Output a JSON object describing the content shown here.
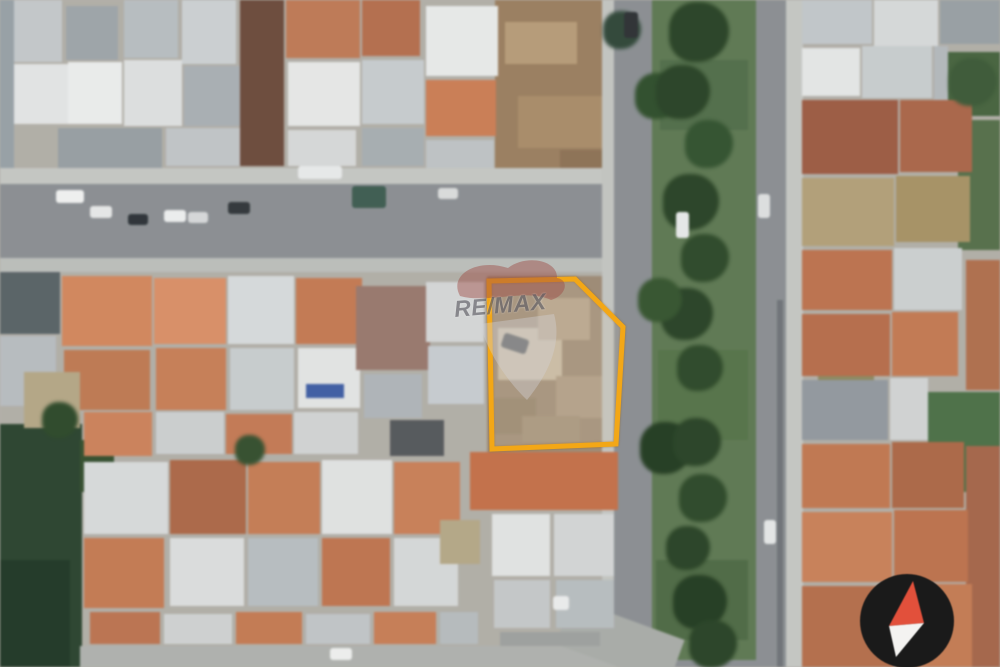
{
  "meta": {
    "width": 1000,
    "height": 667
  },
  "watermark": {
    "brand": "RE/MAX",
    "text_color": "#5f5e66",
    "text_opacity": 0.65,
    "balloon_top_color": "#9e4a42",
    "balloon_body_color": "#d3d2d6"
  },
  "overlay": {
    "label": "highlighted-lot-boundary",
    "stroke": "#F3A716",
    "stroke_width": 5,
    "fill": "rgba(255,255,255,0.12)",
    "points": [
      [
        489,
        281
      ],
      [
        575,
        279
      ],
      [
        623,
        327
      ],
      [
        616,
        444
      ],
      [
        492,
        449
      ]
    ]
  },
  "compass": {
    "left": 850,
    "top": 564,
    "size": 114,
    "bg": "#1a1a1a",
    "north_color": "#e2503b",
    "south_color": "#f4f3f1",
    "circle": {
      "cx": 57,
      "cy": 57,
      "r": 47
    },
    "north_points": "63,17 74,59 39,62",
    "south_points": "74,59 46,93 39,62"
  },
  "scene": {
    "base": "#b3b0a8",
    "rects": [
      [
        0,
        0,
        14,
        170,
        "#98a2a8"
      ],
      [
        495,
        0,
        122,
        183,
        "#9d8060"
      ],
      [
        505,
        22,
        72,
        42,
        "#b99d78"
      ],
      [
        518,
        96,
        84,
        52,
        "#ab8d69"
      ],
      [
        560,
        150,
        56,
        32,
        "#8f7355"
      ],
      [
        487,
        276,
        136,
        176,
        "#a08c76"
      ],
      [
        498,
        328,
        64,
        52,
        "#cabca4"
      ],
      [
        538,
        298,
        52,
        42,
        "#b7a48b"
      ],
      [
        556,
        376,
        48,
        42,
        "#af9c84"
      ],
      [
        494,
        398,
        42,
        36,
        "#97856c"
      ],
      [
        522,
        416,
        58,
        26,
        "#a5927a"
      ],
      [
        0,
        424,
        82,
        243,
        "#2c4630"
      ],
      [
        0,
        560,
        70,
        107,
        "#223a28"
      ],
      [
        80,
        440,
        34,
        52,
        "#35512f"
      ],
      [
        946,
        52,
        54,
        64,
        "#47663f"
      ],
      [
        958,
        120,
        42,
        130,
        "#56714a"
      ],
      [
        928,
        392,
        72,
        100,
        "#4c7247"
      ],
      [
        818,
        336,
        56,
        44,
        "#8f8a60"
      ],
      [
        0,
        168,
        640,
        16,
        "#c6c8c4"
      ],
      [
        0,
        184,
        640,
        74,
        "#8c9094"
      ],
      [
        0,
        258,
        640,
        14,
        "#bdc0bc"
      ],
      [
        602,
        0,
        14,
        667,
        "#c4c6c2"
      ],
      [
        614,
        0,
        176,
        667,
        "#8c9094"
      ],
      [
        652,
        0,
        104,
        660,
        "#5e7a52"
      ],
      [
        660,
        60,
        88,
        70,
        "#52704a"
      ],
      [
        658,
        350,
        90,
        90,
        "#567549"
      ],
      [
        656,
        560,
        92,
        80,
        "#4f6c45"
      ],
      [
        757,
        0,
        30,
        667,
        "#8c9094"
      ],
      [
        786,
        0,
        17,
        667,
        "#c6c8c4"
      ],
      [
        777,
        300,
        6,
        367,
        "#70757a"
      ],
      [
        80,
        646,
        545,
        21,
        "#b0b3af"
      ],
      [
        560,
        618,
        120,
        48,
        "#aaada9",
        20
      ],
      [
        14,
        0,
        48,
        62,
        "#c5c9cb"
      ],
      [
        14,
        64,
        54,
        60,
        "#e4e6e6"
      ],
      [
        66,
        6,
        52,
        54,
        "#9fa6aa"
      ],
      [
        68,
        62,
        54,
        62,
        "#eceeed"
      ],
      [
        124,
        0,
        54,
        58,
        "#b9bfc2"
      ],
      [
        124,
        60,
        58,
        66,
        "#dfe1e1"
      ],
      [
        58,
        128,
        104,
        40,
        "#99a0a4"
      ],
      [
        182,
        0,
        54,
        64,
        "#cdd2d4"
      ],
      [
        184,
        66,
        56,
        60,
        "#aab1b5"
      ],
      [
        166,
        128,
        76,
        38,
        "#c2c6c8"
      ],
      [
        240,
        0,
        44,
        166,
        "#6f4c3c"
      ],
      [
        286,
        0,
        74,
        58,
        "#c27a55"
      ],
      [
        288,
        62,
        72,
        64,
        "#e8e9e8"
      ],
      [
        288,
        130,
        68,
        36,
        "#d8dada"
      ],
      [
        362,
        0,
        58,
        56,
        "#b86f4d"
      ],
      [
        362,
        60,
        62,
        64,
        "#c8cdd0"
      ],
      [
        426,
        6,
        72,
        70,
        "#e9ebea"
      ],
      [
        426,
        80,
        70,
        56,
        "#cf7e53"
      ],
      [
        426,
        140,
        68,
        28,
        "#c0c4c6"
      ],
      [
        362,
        128,
        62,
        38,
        "#a8afb3"
      ],
      [
        0,
        272,
        60,
        62,
        "#5a6468"
      ],
      [
        0,
        336,
        56,
        70,
        "#b9bec1"
      ],
      [
        62,
        276,
        90,
        70,
        "#d6885c"
      ],
      [
        64,
        350,
        86,
        60,
        "#c27a52"
      ],
      [
        24,
        372,
        56,
        56,
        "#b6a886"
      ],
      [
        154,
        278,
        72,
        66,
        "#dd9066"
      ],
      [
        156,
        348,
        70,
        62,
        "#cb7f56"
      ],
      [
        228,
        276,
        66,
        68,
        "#d8dcdd"
      ],
      [
        230,
        348,
        64,
        62,
        "#c9cecf"
      ],
      [
        296,
        278,
        66,
        66,
        "#c87a52"
      ],
      [
        298,
        348,
        62,
        60,
        "#e4e6e5"
      ],
      [
        306,
        384,
        38,
        14,
        "#3f5fa8"
      ],
      [
        356,
        286,
        74,
        84,
        "#9b7a6e"
      ],
      [
        364,
        374,
        58,
        44,
        "#b0b6ba"
      ],
      [
        390,
        420,
        54,
        36,
        "#565a5d"
      ],
      [
        426,
        282,
        58,
        60,
        "#d5d8d8"
      ],
      [
        428,
        346,
        56,
        58,
        "#c8cdd2"
      ],
      [
        84,
        412,
        68,
        44,
        "#d0835a"
      ],
      [
        156,
        412,
        68,
        42,
        "#cdd0d1"
      ],
      [
        226,
        414,
        66,
        40,
        "#c87a54"
      ],
      [
        294,
        412,
        64,
        42,
        "#d2d5d5"
      ],
      [
        84,
        462,
        84,
        72,
        "#d9dcdc"
      ],
      [
        84,
        538,
        80,
        70,
        "#c87b52"
      ],
      [
        170,
        460,
        76,
        74,
        "#b06947"
      ],
      [
        170,
        538,
        74,
        68,
        "#dddfdf"
      ],
      [
        248,
        462,
        72,
        72,
        "#c97d54"
      ],
      [
        248,
        538,
        70,
        68,
        "#b9bfc2"
      ],
      [
        322,
        460,
        70,
        74,
        "#e2e4e3"
      ],
      [
        322,
        538,
        68,
        68,
        "#c3754f"
      ],
      [
        394,
        462,
        66,
        72,
        "#cd8057"
      ],
      [
        394,
        538,
        64,
        68,
        "#d7dada"
      ],
      [
        440,
        520,
        40,
        44,
        "#b6a987"
      ],
      [
        90,
        612,
        70,
        32,
        "#bf7450"
      ],
      [
        164,
        614,
        68,
        30,
        "#d0d3d3"
      ],
      [
        236,
        612,
        66,
        32,
        "#c87b52"
      ],
      [
        306,
        614,
        64,
        30,
        "#c2c6c8"
      ],
      [
        374,
        612,
        62,
        32,
        "#cb7e55"
      ],
      [
        440,
        612,
        38,
        32,
        "#b7bdbf"
      ],
      [
        470,
        452,
        148,
        58,
        "#c87148"
      ],
      [
        492,
        514,
        58,
        62,
        "#e3e5e4"
      ],
      [
        554,
        514,
        60,
        62,
        "#d4d7d7"
      ],
      [
        494,
        580,
        56,
        48,
        "#c6c9ca"
      ],
      [
        556,
        580,
        58,
        48,
        "#b9bfc1"
      ],
      [
        500,
        632,
        100,
        14,
        "#9fa2a0"
      ],
      [
        802,
        0,
        70,
        44,
        "#c3c8cb"
      ],
      [
        874,
        0,
        64,
        46,
        "#d8dbdb"
      ],
      [
        940,
        0,
        60,
        44,
        "#9aa1a5"
      ],
      [
        802,
        48,
        58,
        48,
        "#e6e8e7"
      ],
      [
        862,
        46,
        70,
        52,
        "#c9ced0"
      ],
      [
        934,
        46,
        14,
        58,
        "#b4babd"
      ],
      [
        802,
        100,
        96,
        74,
        "#a05c43"
      ],
      [
        900,
        100,
        72,
        72,
        "#ae6749"
      ],
      [
        802,
        178,
        92,
        68,
        "#b4a178"
      ],
      [
        896,
        176,
        74,
        66,
        "#a99464"
      ],
      [
        802,
        250,
        90,
        60,
        "#c0734e"
      ],
      [
        894,
        248,
        68,
        62,
        "#cdd1d2"
      ],
      [
        966,
        260,
        34,
        130,
        "#b3704d"
      ],
      [
        802,
        314,
        88,
        62,
        "#ba6e4a"
      ],
      [
        892,
        312,
        66,
        64,
        "#c77a52"
      ],
      [
        802,
        380,
        86,
        60,
        "#939aa0"
      ],
      [
        890,
        378,
        38,
        62,
        "#d2d5d5"
      ],
      [
        802,
        444,
        88,
        64,
        "#c5784f"
      ],
      [
        892,
        442,
        72,
        66,
        "#b06946"
      ],
      [
        966,
        446,
        34,
        221,
        "#a8674a"
      ],
      [
        802,
        512,
        90,
        70,
        "#cd8258"
      ],
      [
        894,
        510,
        74,
        72,
        "#c0734c"
      ],
      [
        802,
        586,
        92,
        81,
        "#b86f4b"
      ],
      [
        896,
        584,
        76,
        83,
        "#c87c53"
      ]
    ],
    "trees": [
      [
        699,
        32,
        60,
        "#2a4527"
      ],
      [
        658,
        96,
        46,
        "#30502c"
      ],
      [
        683,
        92,
        54,
        "#2a4527"
      ],
      [
        709,
        144,
        48,
        "#335430"
      ],
      [
        691,
        202,
        56,
        "#2a4527"
      ],
      [
        705,
        258,
        48,
        "#2e4b2a"
      ],
      [
        687,
        314,
        52,
        "#2a4527"
      ],
      [
        660,
        300,
        44,
        "#36562f"
      ],
      [
        700,
        368,
        46,
        "#2e4b2a"
      ],
      [
        666,
        448,
        52,
        "#243e22"
      ],
      [
        697,
        442,
        48,
        "#2a4527"
      ],
      [
        703,
        498,
        48,
        "#2e4b2a"
      ],
      [
        688,
        548,
        44,
        "#2a4527"
      ],
      [
        700,
        602,
        54,
        "#243e22"
      ],
      [
        713,
        644,
        48,
        "#2a4527"
      ],
      [
        973,
        82,
        48,
        "#3d5b38"
      ],
      [
        60,
        420,
        36,
        "#2e4b2a"
      ],
      [
        250,
        450,
        30,
        "#35512f"
      ],
      [
        622,
        30,
        38,
        "#31493a"
      ]
    ],
    "cars": [
      [
        56,
        190,
        28,
        13,
        "#f1f2f1",
        0
      ],
      [
        90,
        206,
        22,
        12,
        "#e8e9e9",
        0
      ],
      [
        128,
        214,
        20,
        11,
        "#2e3439",
        0
      ],
      [
        164,
        210,
        22,
        12,
        "#eef0f0",
        0
      ],
      [
        188,
        212,
        20,
        11,
        "#d8dadb",
        0
      ],
      [
        228,
        202,
        22,
        12,
        "#33383c",
        0
      ],
      [
        298,
        166,
        44,
        13,
        "#e9ebeb",
        0
      ],
      [
        352,
        186,
        34,
        22,
        "#3e5e52",
        0
      ],
      [
        438,
        188,
        20,
        11,
        "#dcdedd",
        0
      ],
      [
        676,
        212,
        13,
        26,
        "#e8eaea",
        0
      ],
      [
        758,
        194,
        12,
        24,
        "#dfe1e1",
        0
      ],
      [
        624,
        12,
        14,
        26,
        "#2f3336",
        0
      ],
      [
        330,
        648,
        22,
        12,
        "#eff0ef",
        0
      ],
      [
        502,
        336,
        26,
        15,
        "#3a3e40",
        18
      ],
      [
        764,
        520,
        12,
        24,
        "#e6e8e8",
        0
      ],
      [
        553,
        596,
        16,
        14,
        "#eceded",
        0
      ]
    ]
  }
}
